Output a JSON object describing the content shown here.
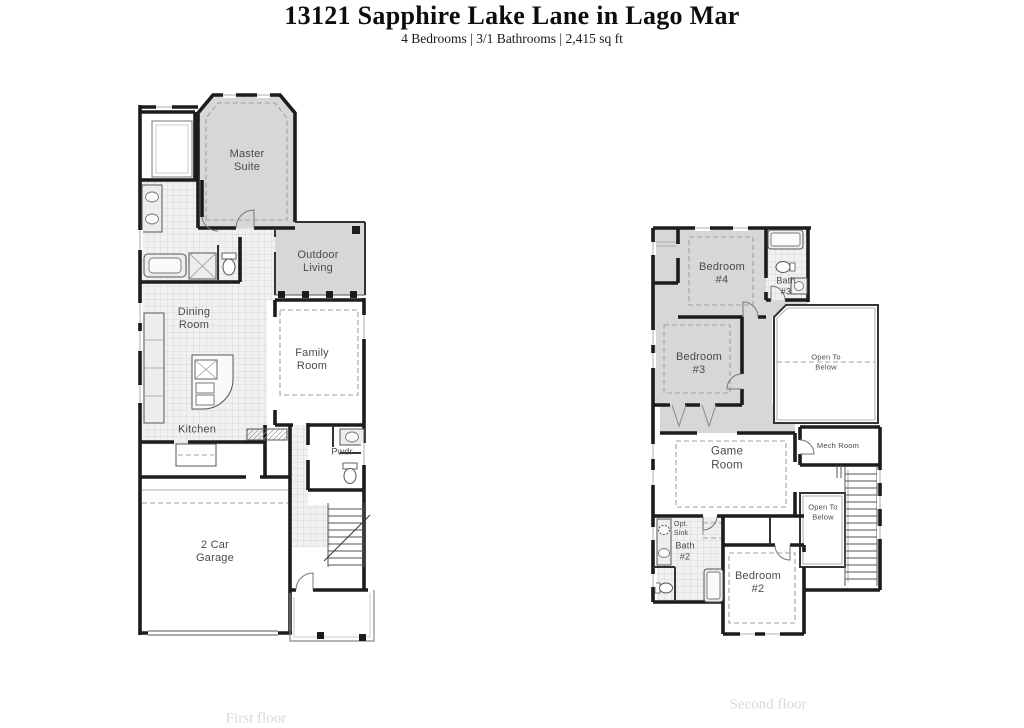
{
  "header": {
    "title": "13121 Sapphire Lake Lane in Lago Mar",
    "subtitle": "4 Bedrooms | 3/1 Bathrooms | 2,415 sq ft"
  },
  "first_floor": {
    "caption": "First floor",
    "rooms": {
      "master_suite": "Master\nSuite",
      "outdoor_living": "Outdoor\nLiving",
      "dining_room": "Dining\nRoom",
      "family_room": "Family\nRoom",
      "kitchen": "Kitchen",
      "powder": "Pwdr",
      "garage": "2 Car\nGarage"
    }
  },
  "second_floor": {
    "caption": "Second floor",
    "rooms": {
      "bedroom_4": "Bedroom\n#4",
      "bath_3": "Bath\n#3",
      "bedroom_3": "Bedroom\n#3",
      "open_to_below_upper": "Open To\nBelow",
      "game_room": "Game\nRoom",
      "mech_room": "Mech Room",
      "open_to_below_lower": "Open To\nBelow",
      "opt_sink": "Opt.\nSink",
      "bath_2": "Bath\n#2",
      "bedroom_2": "Bedroom\n#2"
    }
  },
  "colors": {
    "wall": "#1c1c1c",
    "room_shading": "#d7d7d7",
    "label_text": "#4a4a4a",
    "caption_text": "#d9d9d9"
  }
}
